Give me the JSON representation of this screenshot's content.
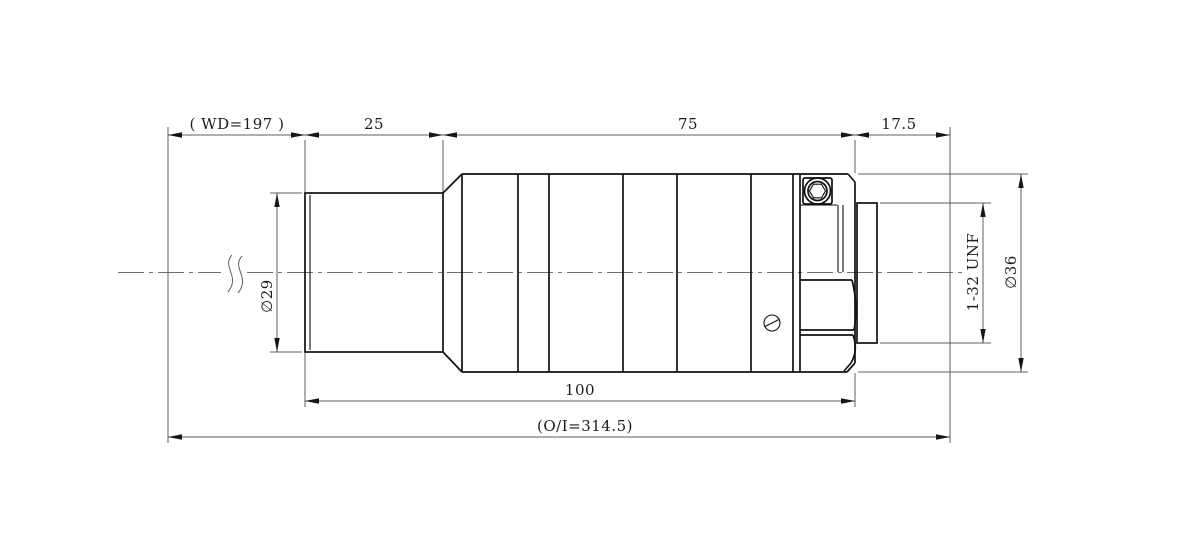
{
  "drawing": {
    "top_dimensions": {
      "working_distance": "( WD=197 )",
      "front_section": "25",
      "mid_section": "75",
      "flange_to_image": "17.5"
    },
    "bottom_dimensions": {
      "housing_length": "100",
      "object_to_image": "(O/I=314.5)"
    },
    "diameters": {
      "front_barrel": "∅29",
      "mount_thread": "1-32 UNF",
      "main_body": "∅36"
    }
  }
}
